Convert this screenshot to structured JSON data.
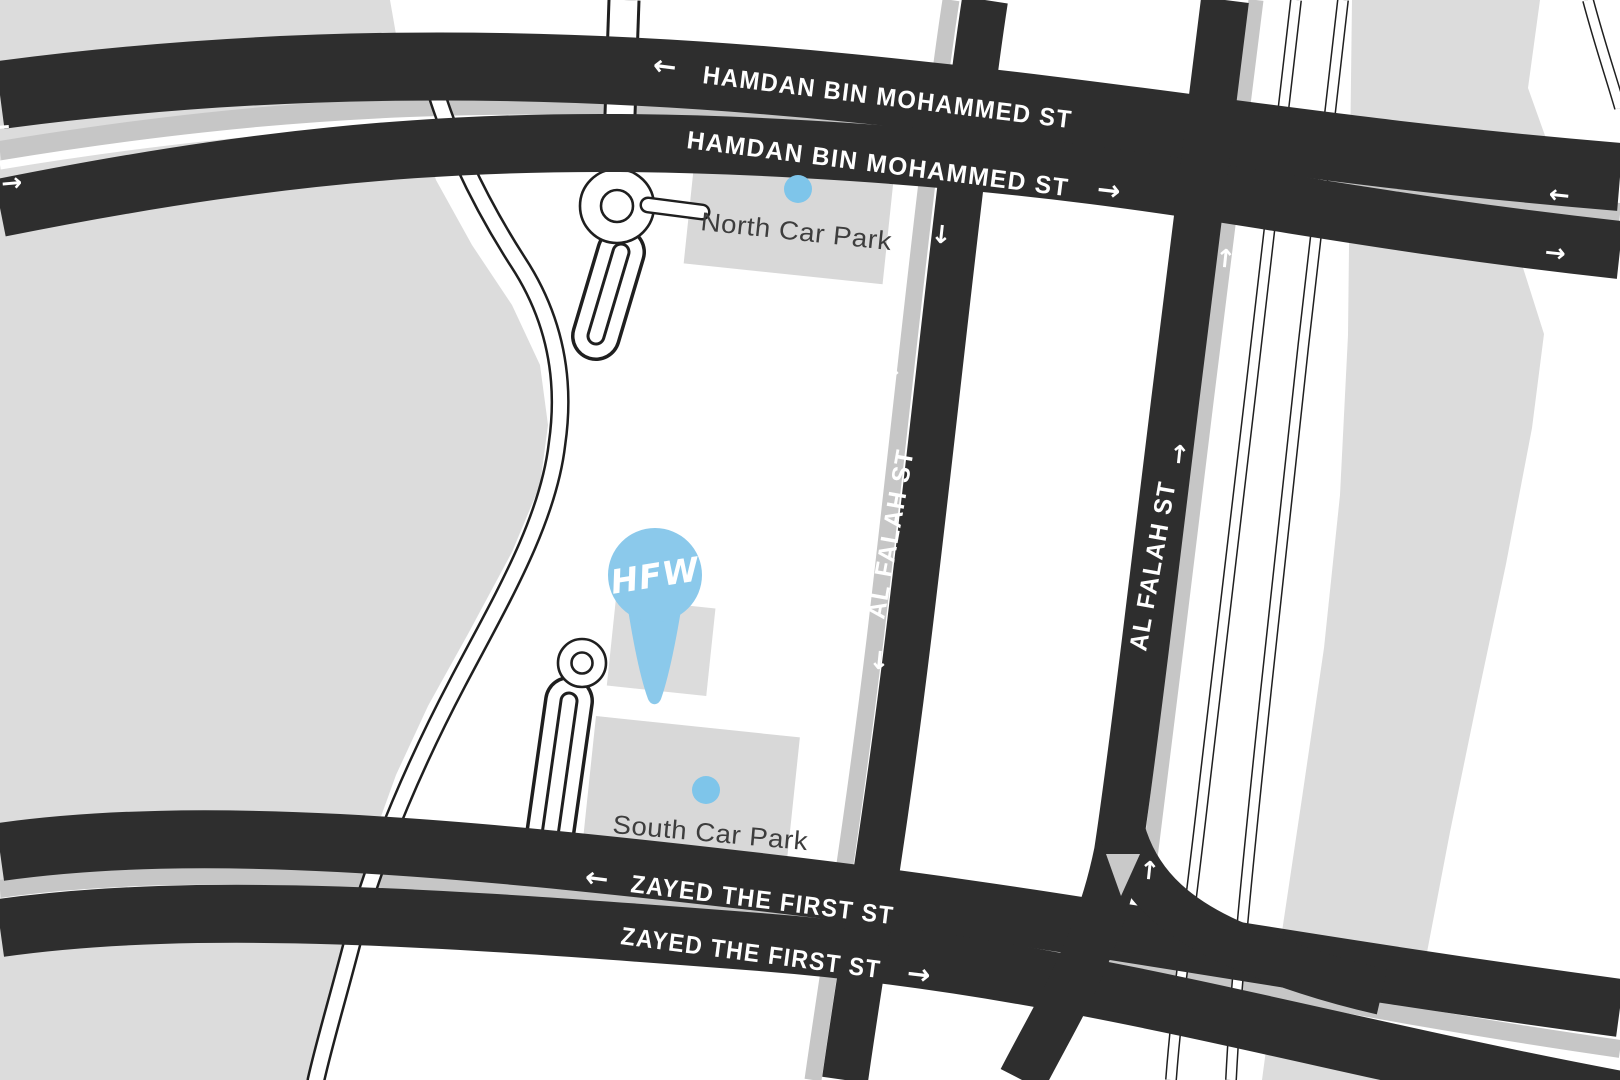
{
  "colors": {
    "road_dark": "#2e2e2e",
    "land_gray": "#dcdcdc",
    "median_gray": "#c6c6c6",
    "accent_blue": "#7EC5EA",
    "pin_blue": "#8BC9EB",
    "park_text": "#3d3d3d",
    "white": "#ffffff"
  },
  "streets": {
    "hamdan_upper": {
      "name": "HAMDAN BIN MOHAMMED ST",
      "direction_arrow": "←"
    },
    "hamdan_lower": {
      "name": "HAMDAN BIN MOHAMMED ST",
      "direction_arrow": "→"
    },
    "zayed_upper": {
      "name": "ZAYED THE FIRST ST",
      "direction_arrow": "←"
    },
    "zayed_lower": {
      "name": "ZAYED THE FIRST ST",
      "direction_arrow": "→"
    },
    "al_falah_west": {
      "name": "AL FALAH ST",
      "direction_arrow": "↓"
    },
    "al_falah_east": {
      "name": "AL FALAH ST",
      "direction_arrow": "↑"
    }
  },
  "arrows": {
    "left": "←",
    "right": "→",
    "up": "↑",
    "down": "↓"
  },
  "pois": {
    "north_car_park": {
      "label": "North Car Park"
    },
    "south_car_park": {
      "label": "South Car Park"
    },
    "marker": {
      "label": "HFW"
    }
  }
}
